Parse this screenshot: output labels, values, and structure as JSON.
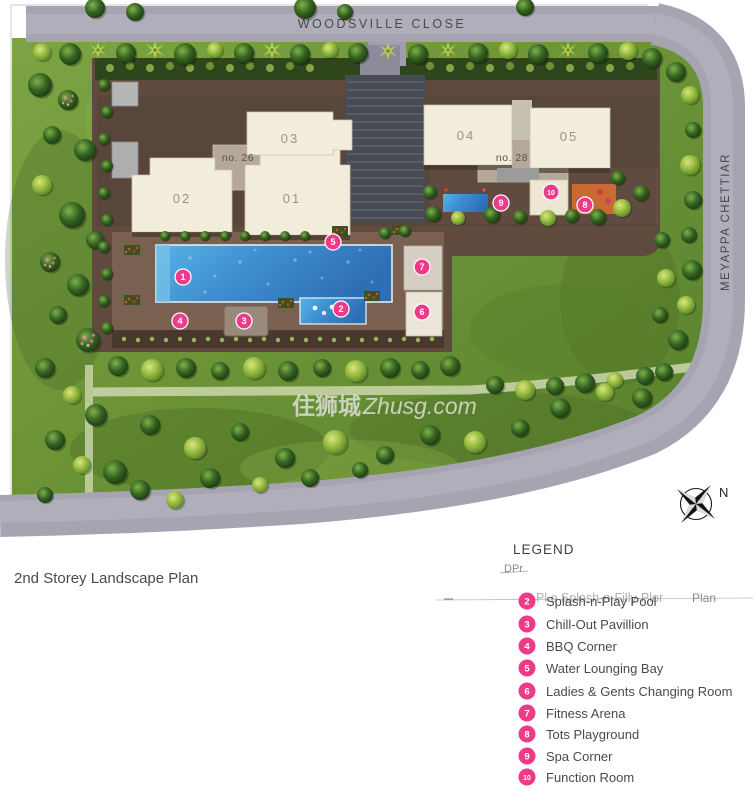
{
  "plan": {
    "title": "2nd Storey Landscape Plan",
    "watermark_cn": "住狮城",
    "watermark_en": "Zhusg.com"
  },
  "roads": {
    "top_label": "WOODSVILLE CLOSE",
    "right_label": "MEYAPPA CHETTIAR"
  },
  "compass": {
    "north_label": "N"
  },
  "buildings": [
    {
      "label": "02"
    },
    {
      "label": "01"
    },
    {
      "label": "03"
    },
    {
      "label": "no. 26"
    },
    {
      "label": "04"
    },
    {
      "label": "05"
    },
    {
      "label": "no. 28"
    }
  ],
  "markers": [
    {
      "n": "1"
    },
    {
      "n": "2"
    },
    {
      "n": "3"
    },
    {
      "n": "4"
    },
    {
      "n": "5"
    },
    {
      "n": "6"
    },
    {
      "n": "7"
    },
    {
      "n": "8"
    },
    {
      "n": "9"
    },
    {
      "n": "10"
    }
  ],
  "legend": {
    "heading": "LEGEND",
    "scan_artifact_small": "DPr",
    "scan_artifact_ghost": "Pl o Splash-n-Filly-Plor",
    "scan_artifact_plan": "Plan",
    "items": [
      {
        "num": "2",
        "label": "Splash-n-Play Pool"
      },
      {
        "num": "3",
        "label": "Chill-Out Pavillion"
      },
      {
        "num": "4",
        "label": "BBQ Corner"
      },
      {
        "num": "5",
        "label": "Water Lounging Bay"
      },
      {
        "num": "6",
        "label": "Ladies & Gents Changing Room"
      },
      {
        "num": "7",
        "label": "Fitness Arena"
      },
      {
        "num": "8",
        "label": "Tots Playground"
      },
      {
        "num": "9",
        "label": "Spa Corner"
      },
      {
        "num": "10",
        "label": "Function Room"
      }
    ]
  },
  "colors": {
    "marker_pink": "#ee3a88",
    "road_gray": "#a7a4b2",
    "grass_green": "#6e9639",
    "deck_brown": "#6b5244",
    "pool_blue": "#3f8fd0",
    "building_cream": "#f3eedb"
  }
}
